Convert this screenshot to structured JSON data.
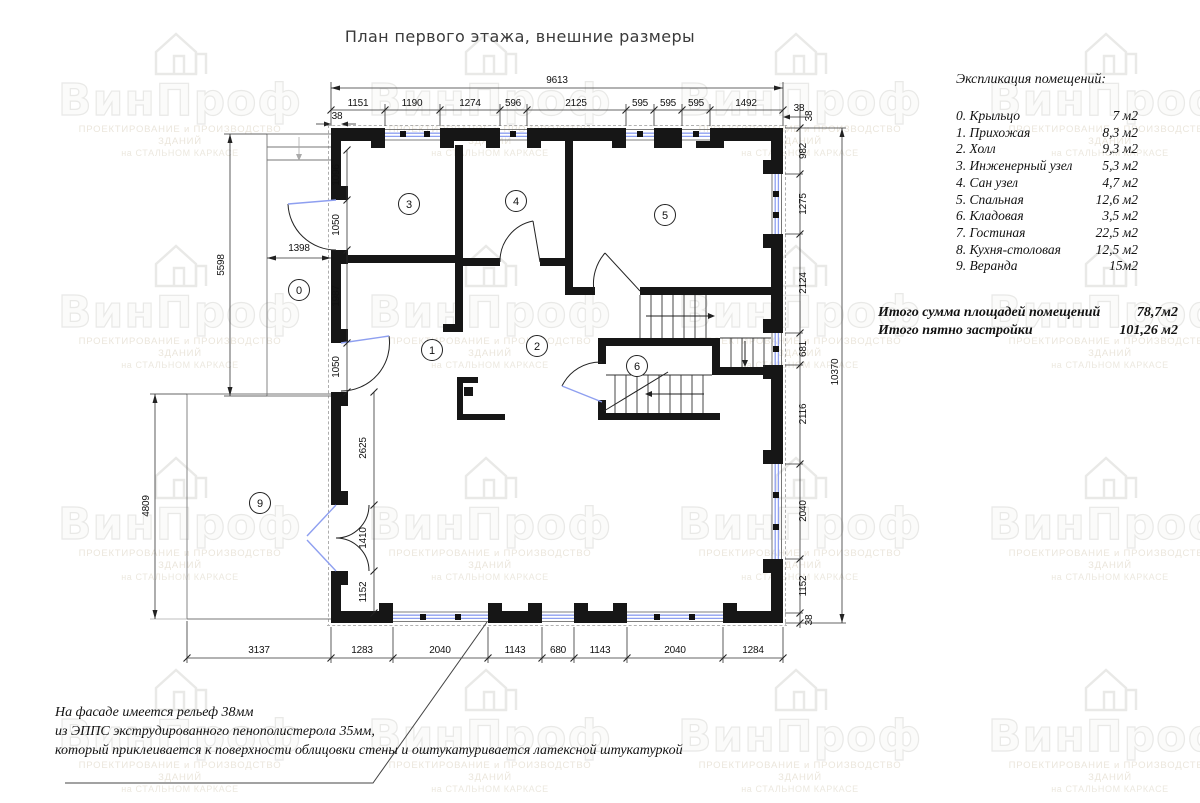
{
  "title": "План первого этажа, внешние размеры",
  "watermark": {
    "brand": "ВинПроф",
    "subtitle1": "ПРОЕКТИРОВАНИЕ и ПРОИЗВОДСТВО ЗДАНИЙ",
    "subtitle2": "на СТАЛЬНОМ КАРКАСЕ"
  },
  "explication": {
    "heading": "Экспликация помещений:",
    "rows": [
      {
        "label": "0. Крыльцо",
        "area": "7 м2"
      },
      {
        "label": "1. Прихожая",
        "area": "8,3 м2"
      },
      {
        "label": "2. Холл",
        "area": "9,3 м2"
      },
      {
        "label": "3. Инженерный узел",
        "area": "5,3 м2"
      },
      {
        "label": "4. Сан узел",
        "area": "4,7 м2"
      },
      {
        "label": "5. Спальная",
        "area": "12,6 м2"
      },
      {
        "label": "6. Кладовая",
        "area": "3,5 м2"
      },
      {
        "label": "7. Гостиная",
        "area": "22,5 м2"
      },
      {
        "label": "8. Кухня-столовая",
        "area": "12,5 м2"
      },
      {
        "label": "9. Веранда",
        "area": "15м2"
      }
    ],
    "totals": [
      {
        "label": "Итого сумма площадей  помещений",
        "value": "78,7м2"
      },
      {
        "label": "Итого пятно застройки",
        "value": "101,26 м2"
      }
    ]
  },
  "note": {
    "line1": "На фасаде имеется рельеф 38мм",
    "line2": "из ЭППС экструдированного пенополистерола 35мм,",
    "line3": "который приклеивается к поверхности облицовки стены и оштукатуривается латексной штукатуркой"
  },
  "plan": {
    "rooms": [
      "0",
      "1",
      "2",
      "3",
      "4",
      "5",
      "6",
      "9"
    ],
    "dims": {
      "top_overall": "9613",
      "top_chain": [
        "1151",
        "1190",
        "1274",
        "596",
        "2125",
        "595",
        "595",
        "595",
        "1492"
      ],
      "right_overall": "10370",
      "right_chain": [
        "982",
        "1275",
        "2124",
        "681",
        "2116",
        "2040",
        "1152"
      ],
      "bottom_chain": [
        "3137",
        "1283",
        "2040",
        "1143",
        "680",
        "1143",
        "2040",
        "1284"
      ],
      "left_inner_chain": [
        "1096",
        "1050",
        "1987",
        "1050",
        "2625",
        "1410",
        "1152"
      ],
      "porch_height": "5598",
      "porch_width": "1398",
      "veranda_height": "4809",
      "offset": "38"
    }
  },
  "colors": {
    "wall": "#161616",
    "window_glazing": "#8e9ff0",
    "dimension": "#333333",
    "watermark": "#ebebe9"
  }
}
